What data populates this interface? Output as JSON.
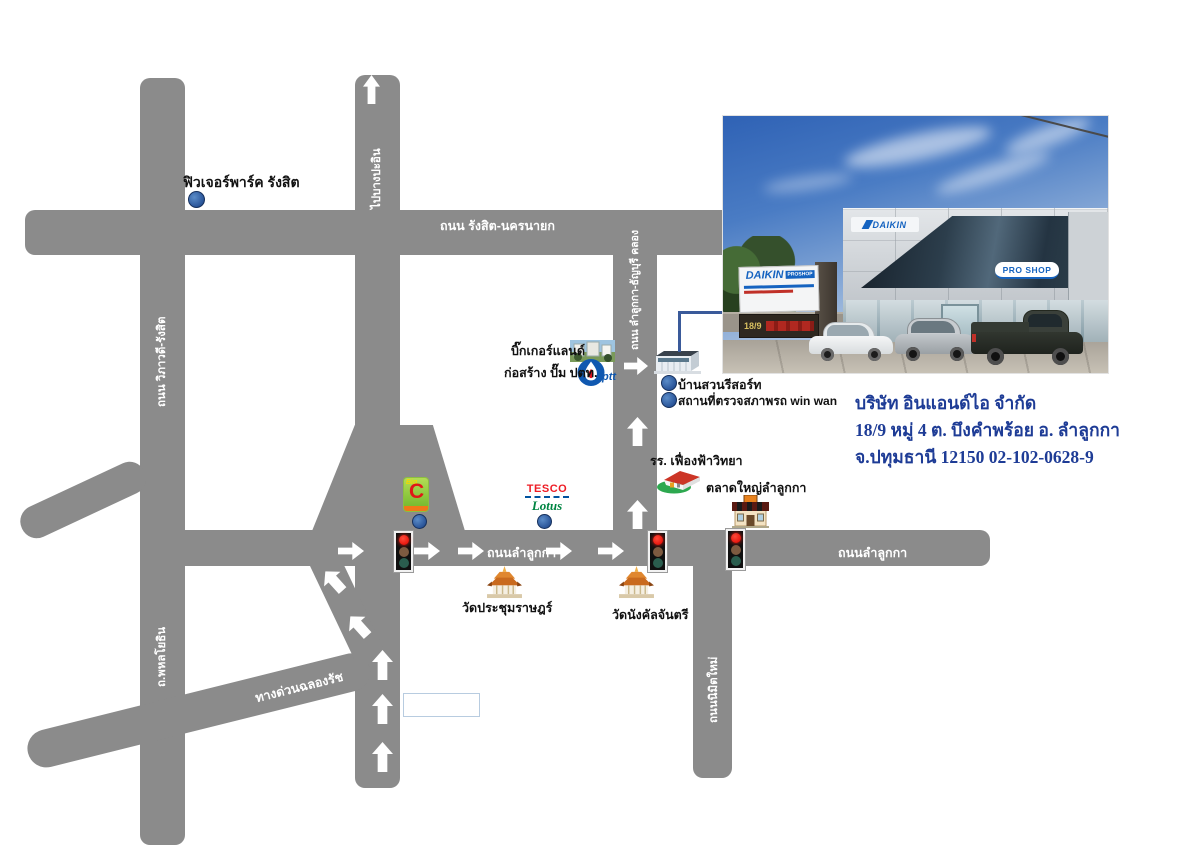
{
  "colors": {
    "road": "#8b8b8b",
    "road_label": "#ffffff",
    "landmark_text": "#111111",
    "company_text": "#1e3c96",
    "location_dot": "#2a5599",
    "traffic_light_red": "#e8170f"
  },
  "company": {
    "name": "บริษัท อินแอนด์ไอ จำกัด",
    "address_line1": "18/9 หมู่ 4 ต. บึงคำพร้อย อ. ลำลูกกา",
    "address_line2": "จ.ปทุมธานี 12150 02-102-0628-9"
  },
  "roads": {
    "rangsit_nakhonnayok": "ถนน รังสิต-นครนายก",
    "to_bang_pa_in": "ไปบางปะอิน",
    "viphavadi_rangsit": "ถนน วิภาวดี-รังสิต",
    "phahonyothin": "ถ.พหลโยธิน",
    "lamlukka_thanyaburi_khlong": "ถนน ลำลูกกา-ธัญบุรี คลอง",
    "lamlukka_center": "ถนนลำลูกกา",
    "lamlukka_east": "ถนนลำลูกกา",
    "nimit_mai": "ถนนนิมิตใหม่",
    "chalong_rat_expressway": "ทางด่วนฉลองรัช"
  },
  "landmarks": {
    "future_park": "ฟิวเจอร์พาร์ค รังสิต",
    "bigger_land": "บิ๊กเกอร์แลนด์",
    "ptt_station": "ก่อสร้าง ปั๊ม ปตท.",
    "baan_suan_resort": "บ้านสวนรีสอร์ท",
    "vehicle_inspection": "สถานที่ตรวจสภาพรถ win wan",
    "school": "รร. เฟื่องฟ้าวิทยา",
    "market": "ตลาดใหญ่ลำลูกกา",
    "temple_prachum_rat": "วัดประชุมราษฎร์",
    "temple_nangkhan_chantri": "วัดนังคัลจันตรี"
  },
  "logos": {
    "bigc_big": "Big",
    "bigc_c": "C",
    "tesco": "TESCO",
    "lotus": "Lotus",
    "ptt": "ptt"
  },
  "photo": {
    "building_logo": "DAIKIN",
    "pro_shop_sign": "PRO SHOP",
    "pylon_daikin": "DAIKIN",
    "pylon_proshop": "PROSHOP",
    "pylon_number": "18/9"
  }
}
